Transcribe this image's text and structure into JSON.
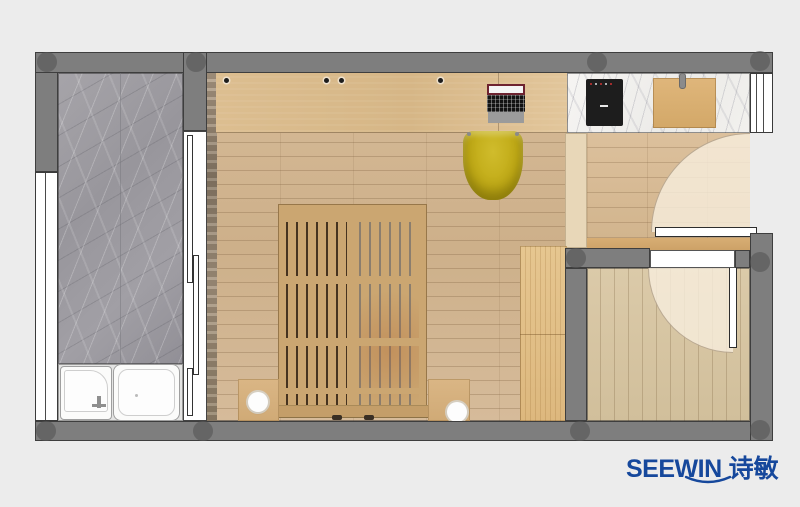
{
  "canvas": {
    "width": 800,
    "height": 507
  },
  "logo": {
    "brand": "SEEWIN",
    "chinese": "诗敏",
    "color": "#16489c"
  },
  "palette": {
    "background": "#ececec",
    "wall": "#7e7e7e",
    "wall_outline": "#3e3e3e",
    "column": "#585858",
    "marble_gray": "#9b9aa0",
    "marble_white": "#f4f3f1",
    "wood_desk": "#d9bb8c",
    "wood_floor": "#d0b491",
    "wood_small_room": "#d7c6a6",
    "wood_wardrobe": "#e0bd85",
    "bed_wood": "#cba671",
    "bed_slat_gap_dark": "#46331f",
    "chair_yellow": "#c0ab18",
    "door_swing": "#f6edda",
    "fixture_white": "#fbfbfa",
    "cooktop_black": "#1d1d1d",
    "logo_blue": "#16489c"
  },
  "plan": {
    "rooms": [
      {
        "name": "bathroom-balcony",
        "floor": "gray-marble"
      },
      {
        "name": "bedroom",
        "floor": "oak-plank"
      },
      {
        "name": "kitchen-entry",
        "floor": "oak-plank"
      },
      {
        "name": "utility-room",
        "floor": "oak-plank-vertical"
      }
    ],
    "furniture": [
      "slatted-bed",
      "nightstand-left",
      "nightstand-right",
      "lamp-left",
      "lamp-right",
      "desk-counter",
      "laptop",
      "yellow-chair",
      "wardrobe",
      "kitchen-counter",
      "cooktop",
      "cutting-board",
      "shower-tray",
      "bathtub",
      "sliding-door",
      "entry-door",
      "utility-door",
      "window-left",
      "window-kitchen"
    ]
  }
}
